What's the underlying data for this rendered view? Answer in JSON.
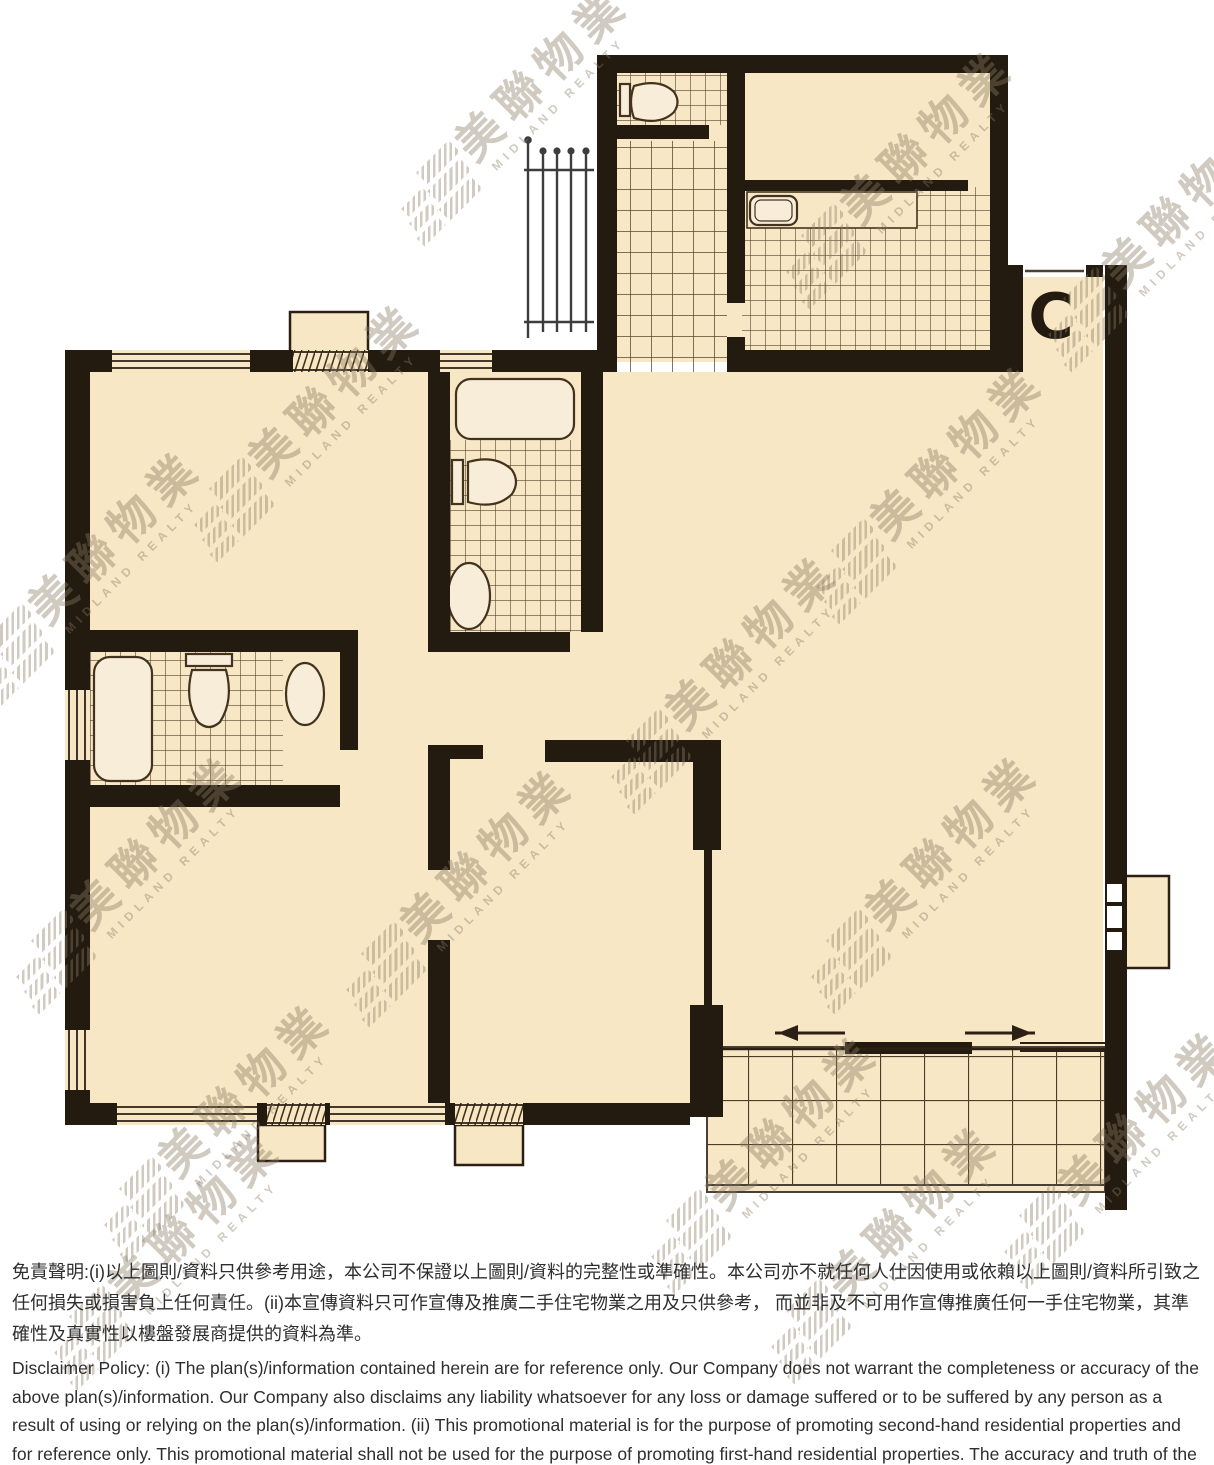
{
  "floorplan": {
    "unit_label": "C",
    "colors": {
      "page_bg": "#FFFFFF",
      "floor": "#F7E7C5",
      "wall": "#241B10",
      "tile_line": "#46331C",
      "fixture_fill": "#F7EDD8",
      "outline": "#2C2014",
      "watermark": "rgba(138,122,98,0.40)",
      "text": "#2E2E2E"
    }
  },
  "watermark": {
    "cn": "美聯物業",
    "en": "MIDLAND REALTY"
  },
  "disclaimer": {
    "zh": "免責聲明:(i)以上圖則/資料只供參考用途，本公司不保證以上圖則/資料的完整性或準確性。本公司亦不就任何人仕因使用或依賴以上圖則/資料所引致之任何損失或損害負上任何責任。(ii)本宣傳資料只可作宣傳及推廣二手住宅物業之用及只供參考， 而並非及不可用作宣傳推廣任何一手住宅物業，其準確性及真實性以樓盤發展商提供的資料為準。",
    "en": "Disclaimer Policy: (i) The plan(s)/information contained herein are for reference only. Our Company does not warrant the completeness or accuracy of the above plan(s)/information. Our Company also disclaims any liability whatsoever for any loss or damage suffered or to be suffered by any person as a result of using or relying on the plan(s)/information. (ii) This promotional material is for the purpose of promoting second-hand residential properties and for reference only. This promotional material shall not be used for the purpose of promoting first-hand residential properties. The accuracy and truth of the information contained in this promotional material shall be subject to information provided by the developers."
  }
}
